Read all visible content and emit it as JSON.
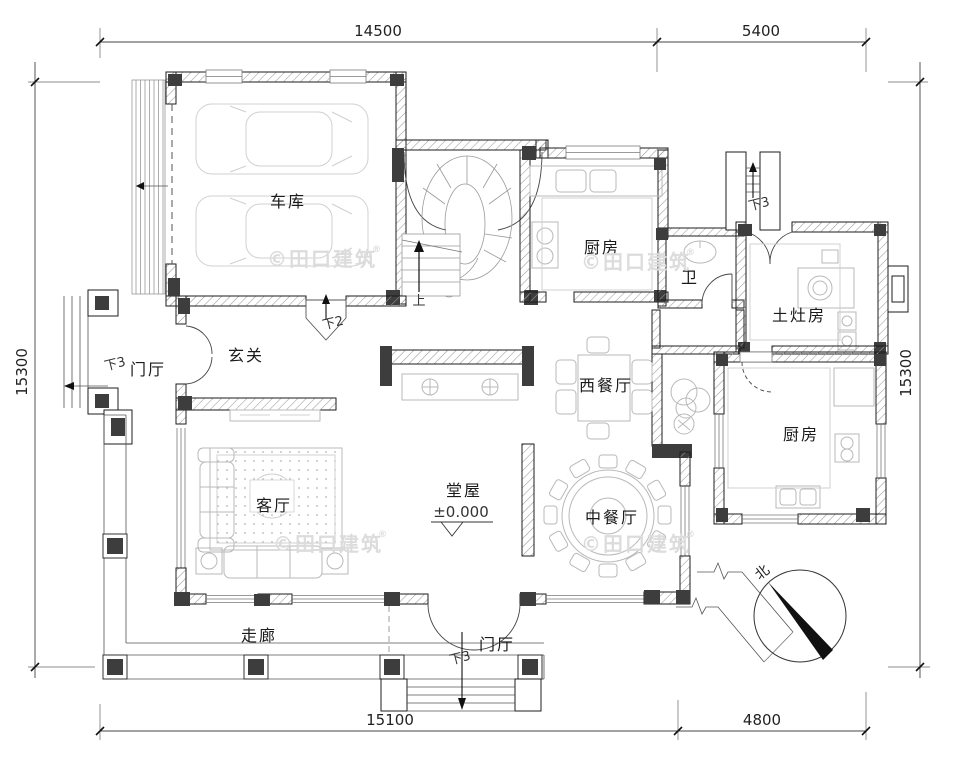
{
  "title": "residential-floor-plan",
  "rooms": {
    "garage": "车库",
    "kitchen_top": "厨房",
    "bath": "卫",
    "stove_room": "土灶房",
    "entry_hall": "玄关",
    "foyer_left": "门厅",
    "west_dining": "西餐厅",
    "kitchen_right": "厨房",
    "living": "客厅",
    "main_hall": "堂屋",
    "chinese_dining": "中餐厅",
    "corridor": "走廊",
    "foyer_bottom": "门厅"
  },
  "annotations": {
    "up": "上",
    "down2": "下2",
    "down3_left": "下3",
    "down3_top": "下3",
    "down3_bottom": "下3",
    "level": "±0.000",
    "north": "北"
  },
  "dimensions": {
    "top_main": "14500",
    "top_right": "5400",
    "left": "15300",
    "right": "15300",
    "bottom_main": "15100",
    "bottom_right": "4800"
  },
  "watermark": {
    "text": "©田口建筑",
    "reg": "®"
  },
  "colors": {
    "wall_line": "#1c1c1c",
    "column_fill": "#3d3d3d",
    "furniture_line": "#b9b9b9",
    "watermark": "#dcdcdc",
    "background": "#ffffff"
  }
}
